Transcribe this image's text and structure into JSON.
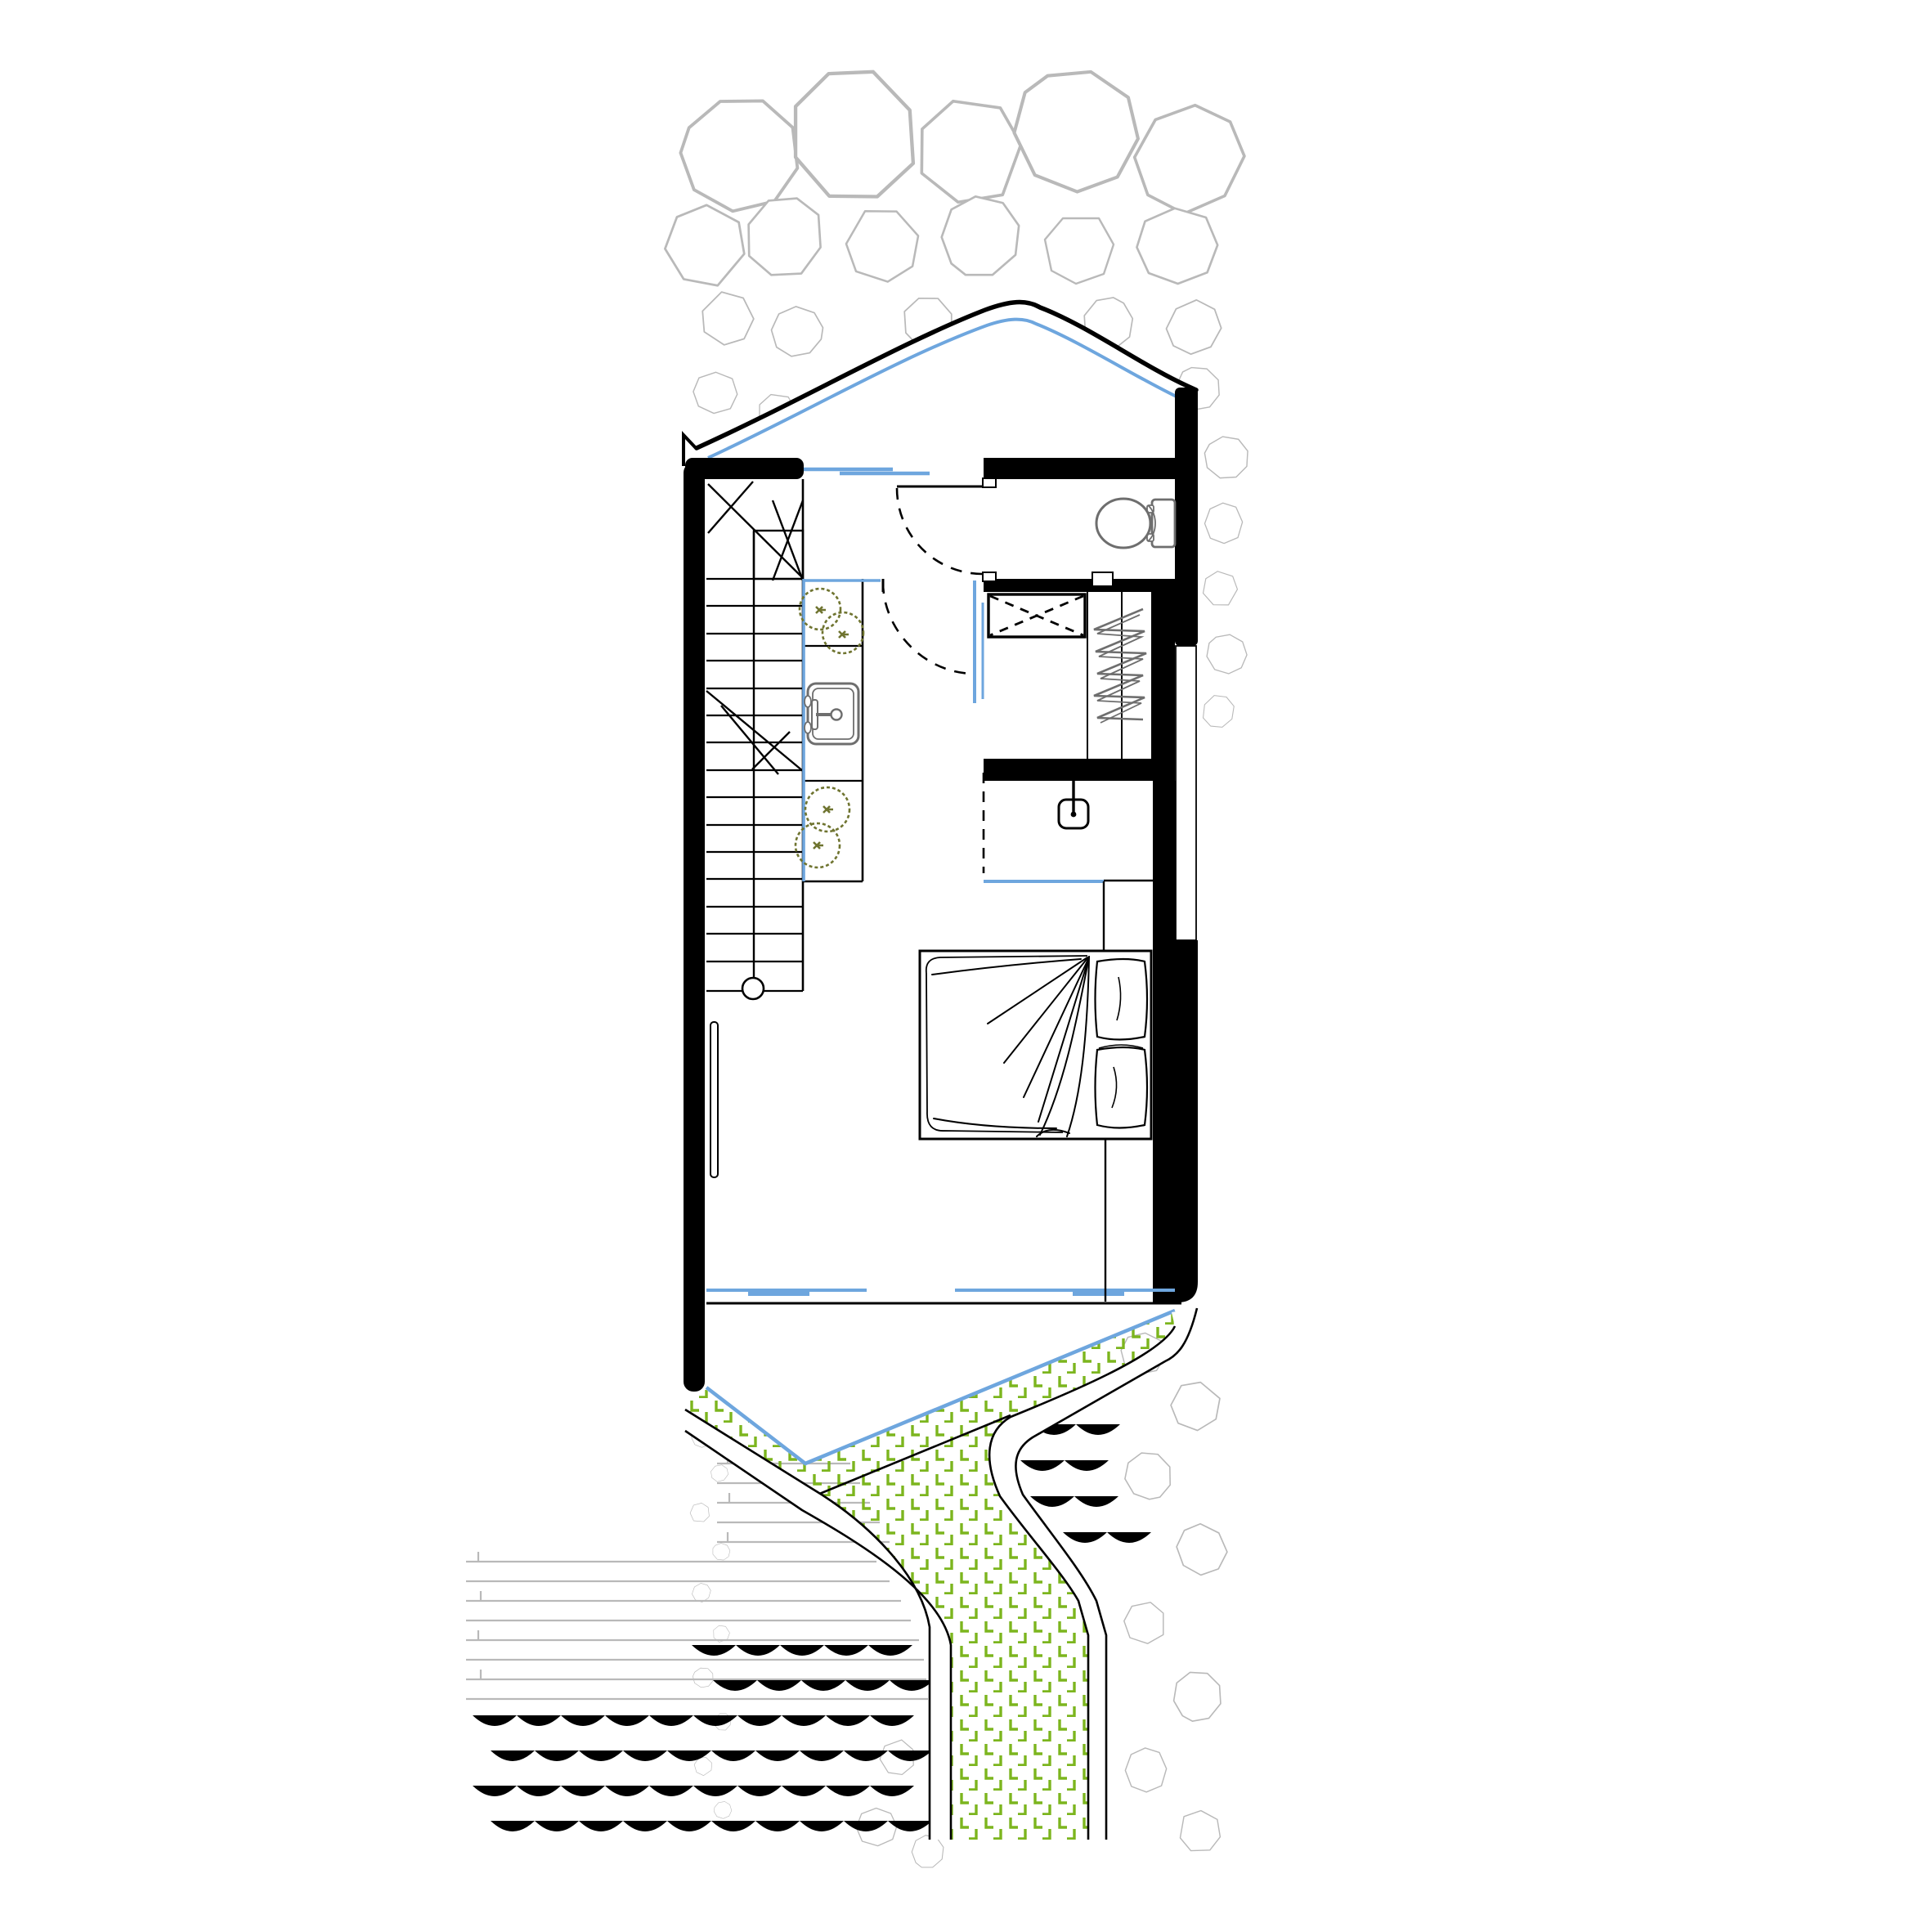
{
  "document": {
    "kind": "architectural-floor-plan",
    "visible_text": [],
    "sheet_background": "#ffffff"
  },
  "colors": {
    "wall": "#000000",
    "stone": "#b9b9b9",
    "glass": "#6ea6de",
    "grass": "#7cb51e",
    "plant": "#6f7430",
    "fixture": "#6e6e6e"
  },
  "plan": {
    "level_features": [
      {
        "name": "angled-roof-edge",
        "style": "black outline with parallel blue glazing line"
      },
      {
        "name": "staircase",
        "treads": 16,
        "newel_circle": true,
        "break_lines": true,
        "direction_arrow": true
      },
      {
        "name": "kitchen-counter",
        "sections": [
          "planter",
          "sink",
          "planter"
        ],
        "glass_edge": "blue"
      },
      {
        "name": "entry-door",
        "swing": "dashed quarter arc"
      },
      {
        "name": "interior-door",
        "swing": "dashed quarter arc",
        "glass_partition": "blue"
      },
      {
        "name": "bathroom",
        "fixtures": [
          "toilet"
        ]
      },
      {
        "name": "appliance-box",
        "marking": "dashed X"
      },
      {
        "name": "wardrobe",
        "marking": "hanging-clothes zigzag"
      },
      {
        "name": "desk-void",
        "marking": "dashed edge + blue edge",
        "furniture": "hanging-chair"
      },
      {
        "name": "bed",
        "pillows": 2,
        "blanket": "hand-drawn folds"
      },
      {
        "name": "window-bench",
        "marking": "double dashed line"
      },
      {
        "name": "radiator-shelf"
      }
    ],
    "site_features": [
      {
        "name": "rock-field-top"
      },
      {
        "name": "stepping-stones",
        "count": 3
      },
      {
        "name": "grass-path",
        "hatch": "green L marks",
        "edge": "blue line"
      },
      {
        "name": "walkway-bands",
        "count": 2
      },
      {
        "name": "timber-deck-lines"
      },
      {
        "name": "water-waves"
      },
      {
        "name": "rock-field-bottom-right"
      },
      {
        "name": "rock-column-bottom-left"
      }
    ]
  }
}
